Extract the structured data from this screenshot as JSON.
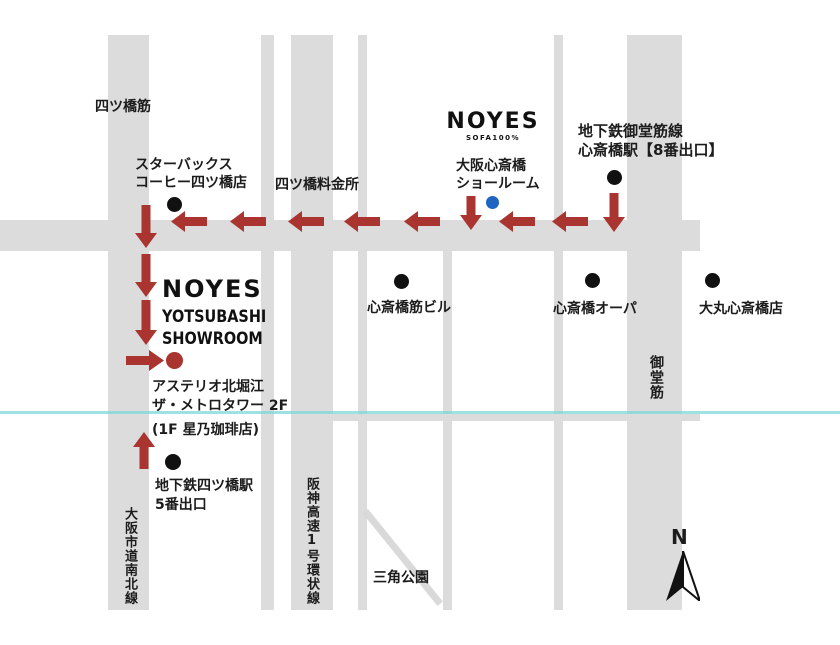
{
  "map": {
    "brand_top": {
      "logo": "NOYES",
      "logo_sub": "SOFA100%",
      "name_line1": "大阪心斎橋",
      "name_line2": "ショールーム"
    },
    "brand_left": {
      "logo": "NOYES",
      "name_line1": "YOTSUBASHI",
      "name_line2": "SHOWROOM"
    },
    "stations": {
      "midosuji_line_1": "地下鉄御堂筋線",
      "midosuji_line_2": "心斎橋駅【8番出口】",
      "yotsubashi_line_1": "地下鉄四ツ橋駅",
      "yotsubashi_line_2": "5番出口"
    },
    "landmarks": {
      "starbucks_1": "スターバックス",
      "starbucks_2": "コーヒー四ツ橋店",
      "tollgate": "四ツ橋料金所",
      "shinsaibashisuji_bldg": "心斎橋筋ビル",
      "opa": "心斎橋オーパ",
      "daimaru": "大丸心斎橋店",
      "sankaku_park": "三角公園",
      "address_1": "アステリオ北堀江",
      "address_2": "ザ・メトロタワー 2F",
      "address_3": "(1F 星乃珈琲店)"
    },
    "roads": {
      "yotsubashi_suji": "四ツ橋筋",
      "osaka_nanboku": "大阪市道南北線",
      "hanshin_expwy": "阪神高速1号環状線",
      "midosuji": "御堂筋"
    },
    "compass": {
      "north": "N"
    },
    "colors": {
      "road": "#dcdcdc",
      "route_arrow": "#a93430",
      "landmark_dot": "#111111",
      "showroom_dot_blue": "#1f64c0",
      "showroom_dot_red": "#a93430",
      "overlay_line": "#7fd6d8"
    }
  }
}
